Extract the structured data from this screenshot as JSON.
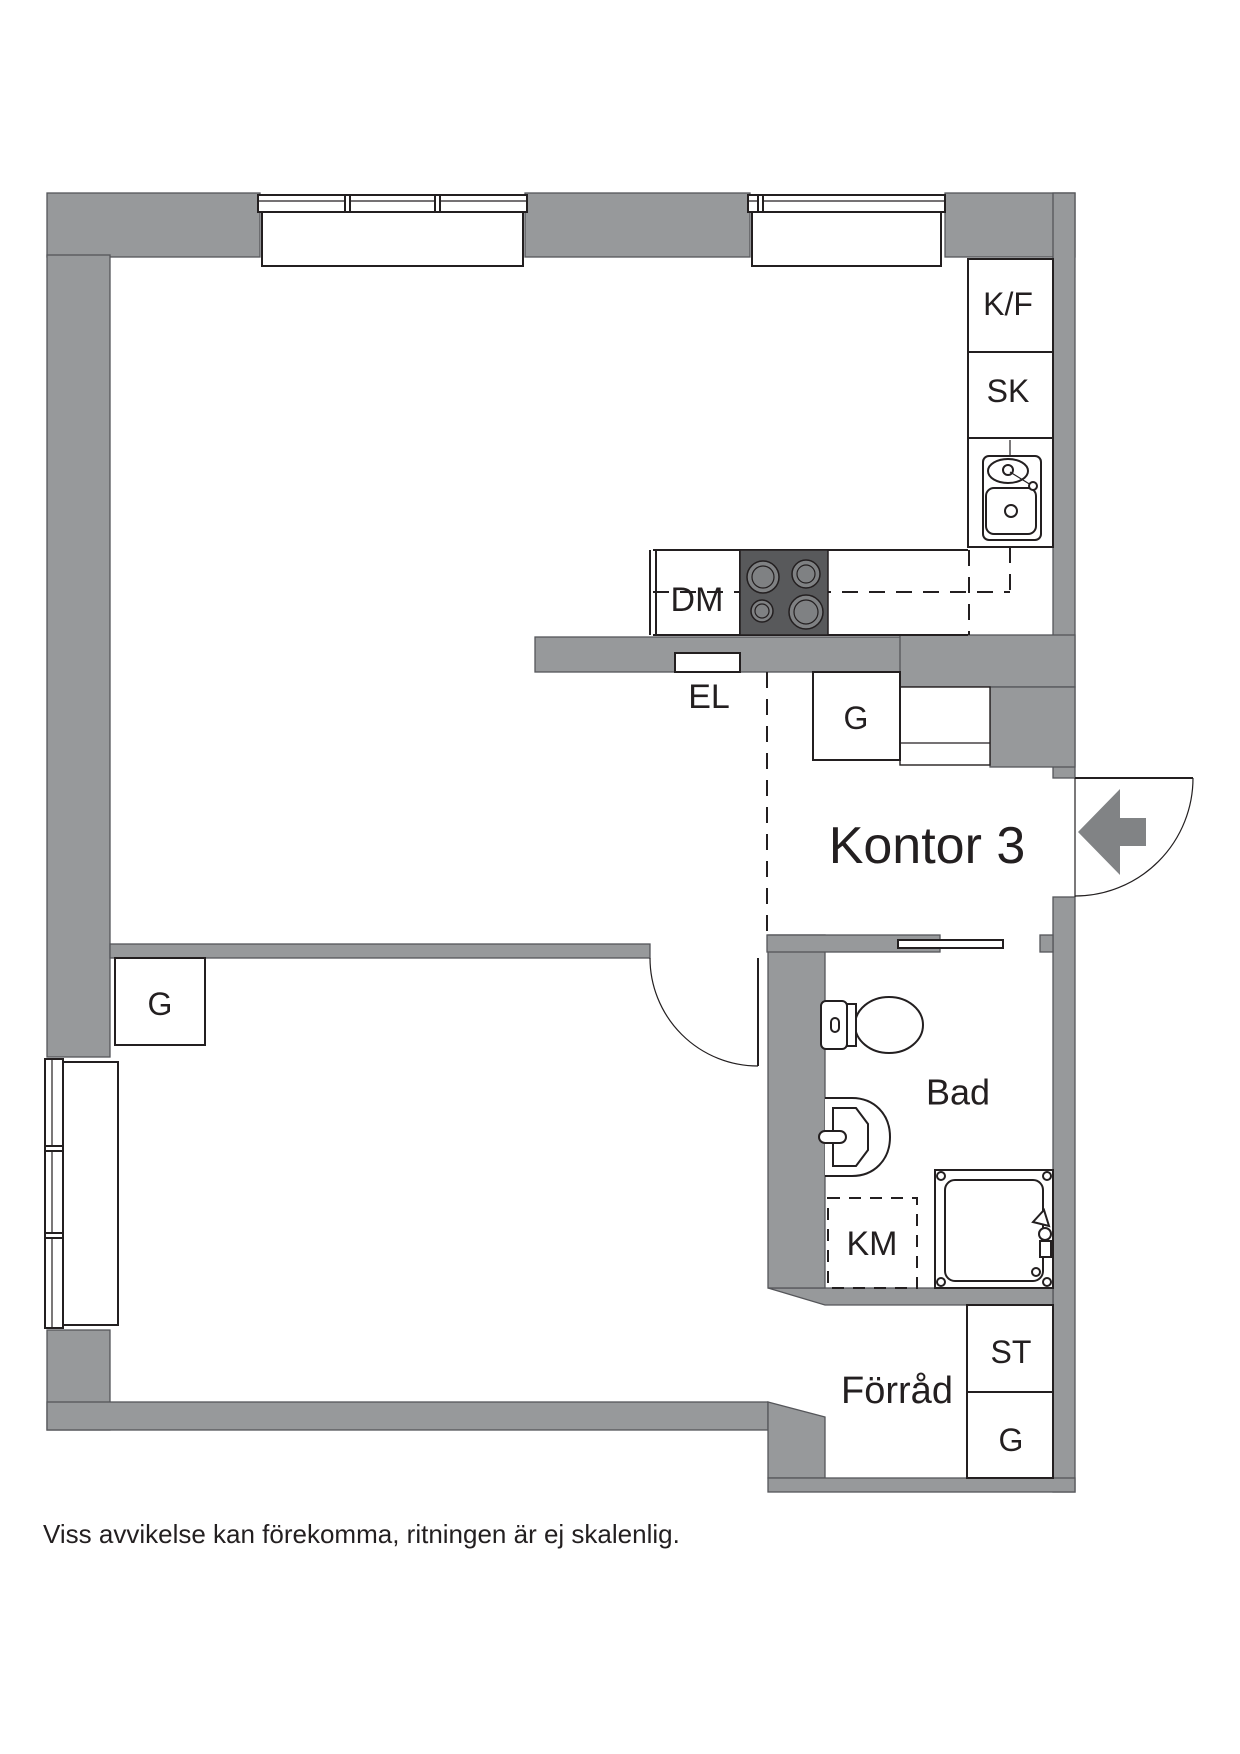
{
  "plan": {
    "room_labels": {
      "hall": "Kontor 3",
      "bathroom": "Bad",
      "storage": "Förråd"
    },
    "fixture_labels": {
      "fridge_freezer": "K/F",
      "tall_cabinet": "SK",
      "dishwasher": "DM",
      "electrical_cabinet": "EL",
      "wardrobe_hall": "G",
      "wardrobe_room": "G",
      "wardrobe_storage": "G",
      "linen_closet": "ST",
      "washing_machine": "KM"
    },
    "disclaimer": "Viss avvikelse kan förekomma, ritningen är ej skalenlig.",
    "colors": {
      "wall": "#97999b",
      "wall_edge": "#55565a",
      "stove": "#58595b",
      "burner": "#7f8183",
      "entrance_arrow": "#818385",
      "line": "#231f20",
      "background": "#ffffff"
    }
  }
}
